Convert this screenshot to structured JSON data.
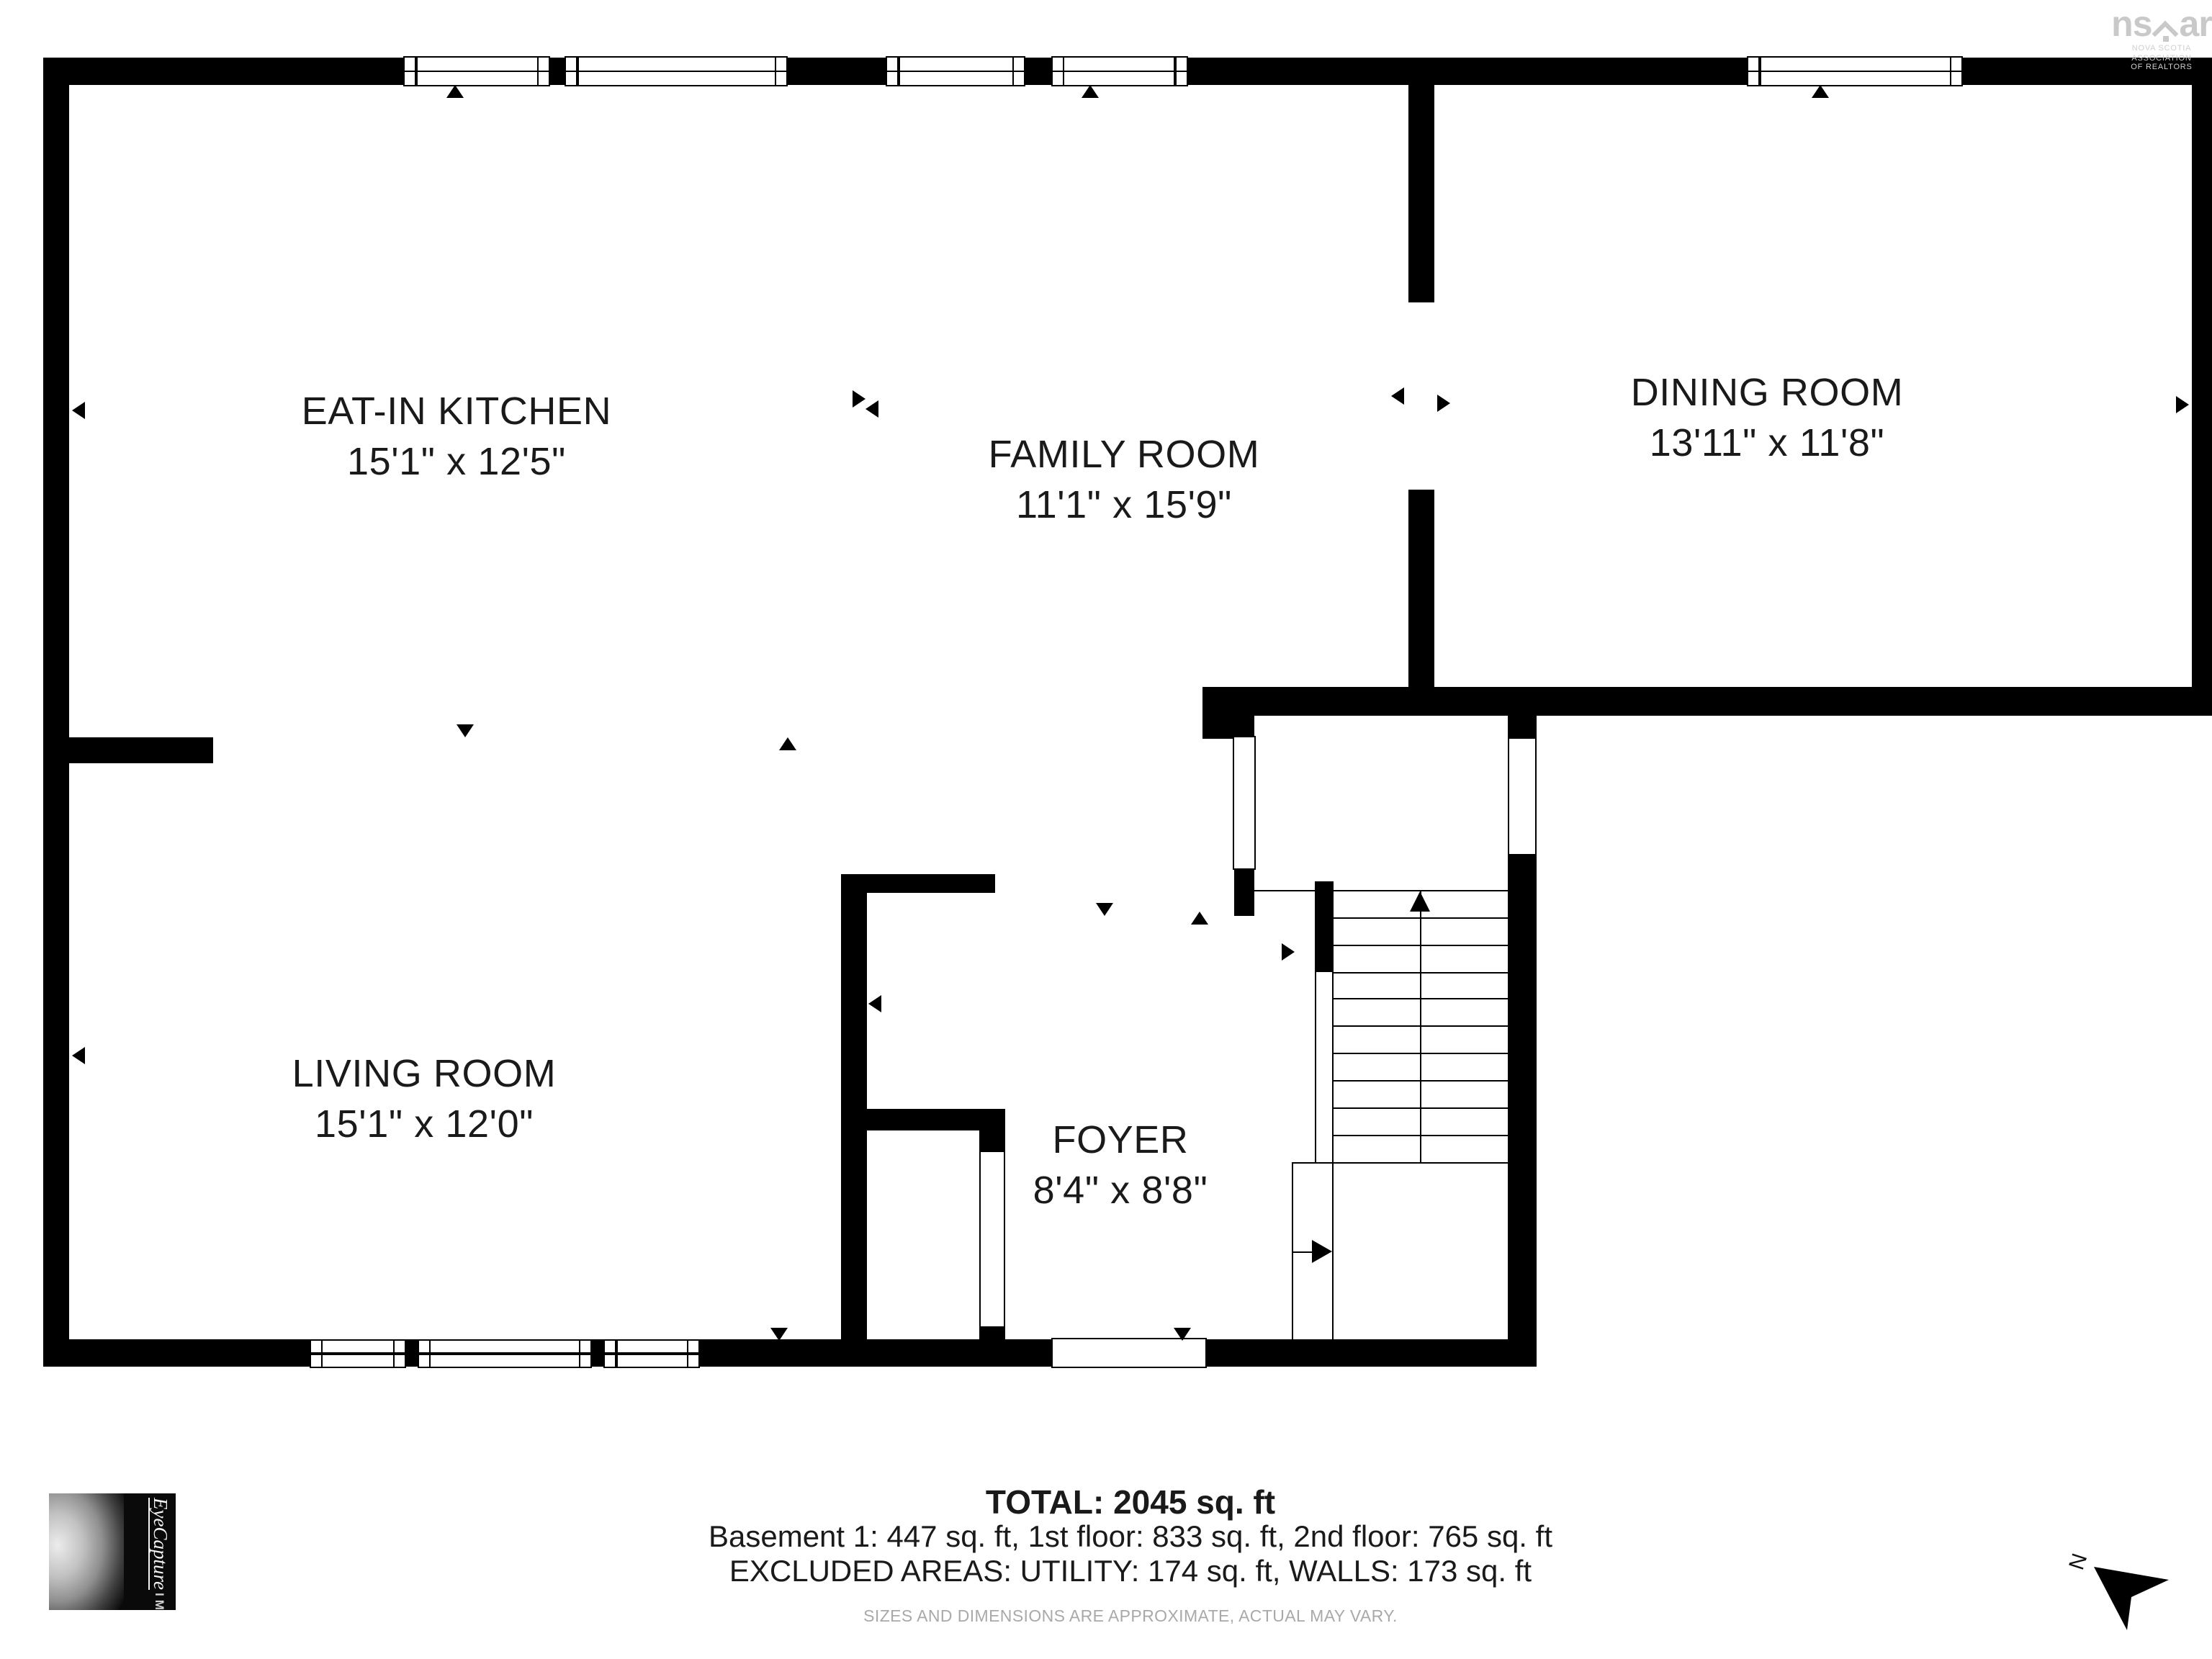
{
  "rooms": [
    {
      "name": "EAT-IN KITCHEN",
      "dims": "15'1\" x 12'5\""
    },
    {
      "name": "FAMILY ROOM",
      "dims": "11'1\" x 15'9\""
    },
    {
      "name": "DINING ROOM",
      "dims": "13'11\" x 11'8\""
    },
    {
      "name": "LIVING ROOM",
      "dims": "15'1\" x 12'0\""
    },
    {
      "name": "FOYER",
      "dims": "8'4\" x 8'8\""
    }
  ],
  "footer": {
    "total": "TOTAL: 2045 sq. ft",
    "breakdown": "Basement 1: 447 sq. ft, 1st floor: 833 sq. ft, 2nd floor: 765 sq. ft",
    "excluded": "EXCLUDED AREAS: UTILITY: 174 sq. ft, WALLS: 173 sq. ft",
    "disclaimer": "SIZES AND DIMENSIONS ARE APPROXIMATE, ACTUAL MAY VARY."
  },
  "branding": {
    "nsar": {
      "wordmark_left": "ns",
      "wordmark_right": "ar",
      "tagline_line1": "NOVA SCOTIA ASSOCIATION",
      "tagline_line2": "OF REALTORS"
    },
    "eyecapture": {
      "script": "EyeCapture",
      "block": "IMAGES"
    }
  },
  "compass": {
    "label": "N"
  },
  "colors": {
    "wall": "#000000",
    "label_text": "#1a1a1a",
    "muted_text": "#a9a9a9",
    "brand_gray": "#c9c9c9"
  }
}
